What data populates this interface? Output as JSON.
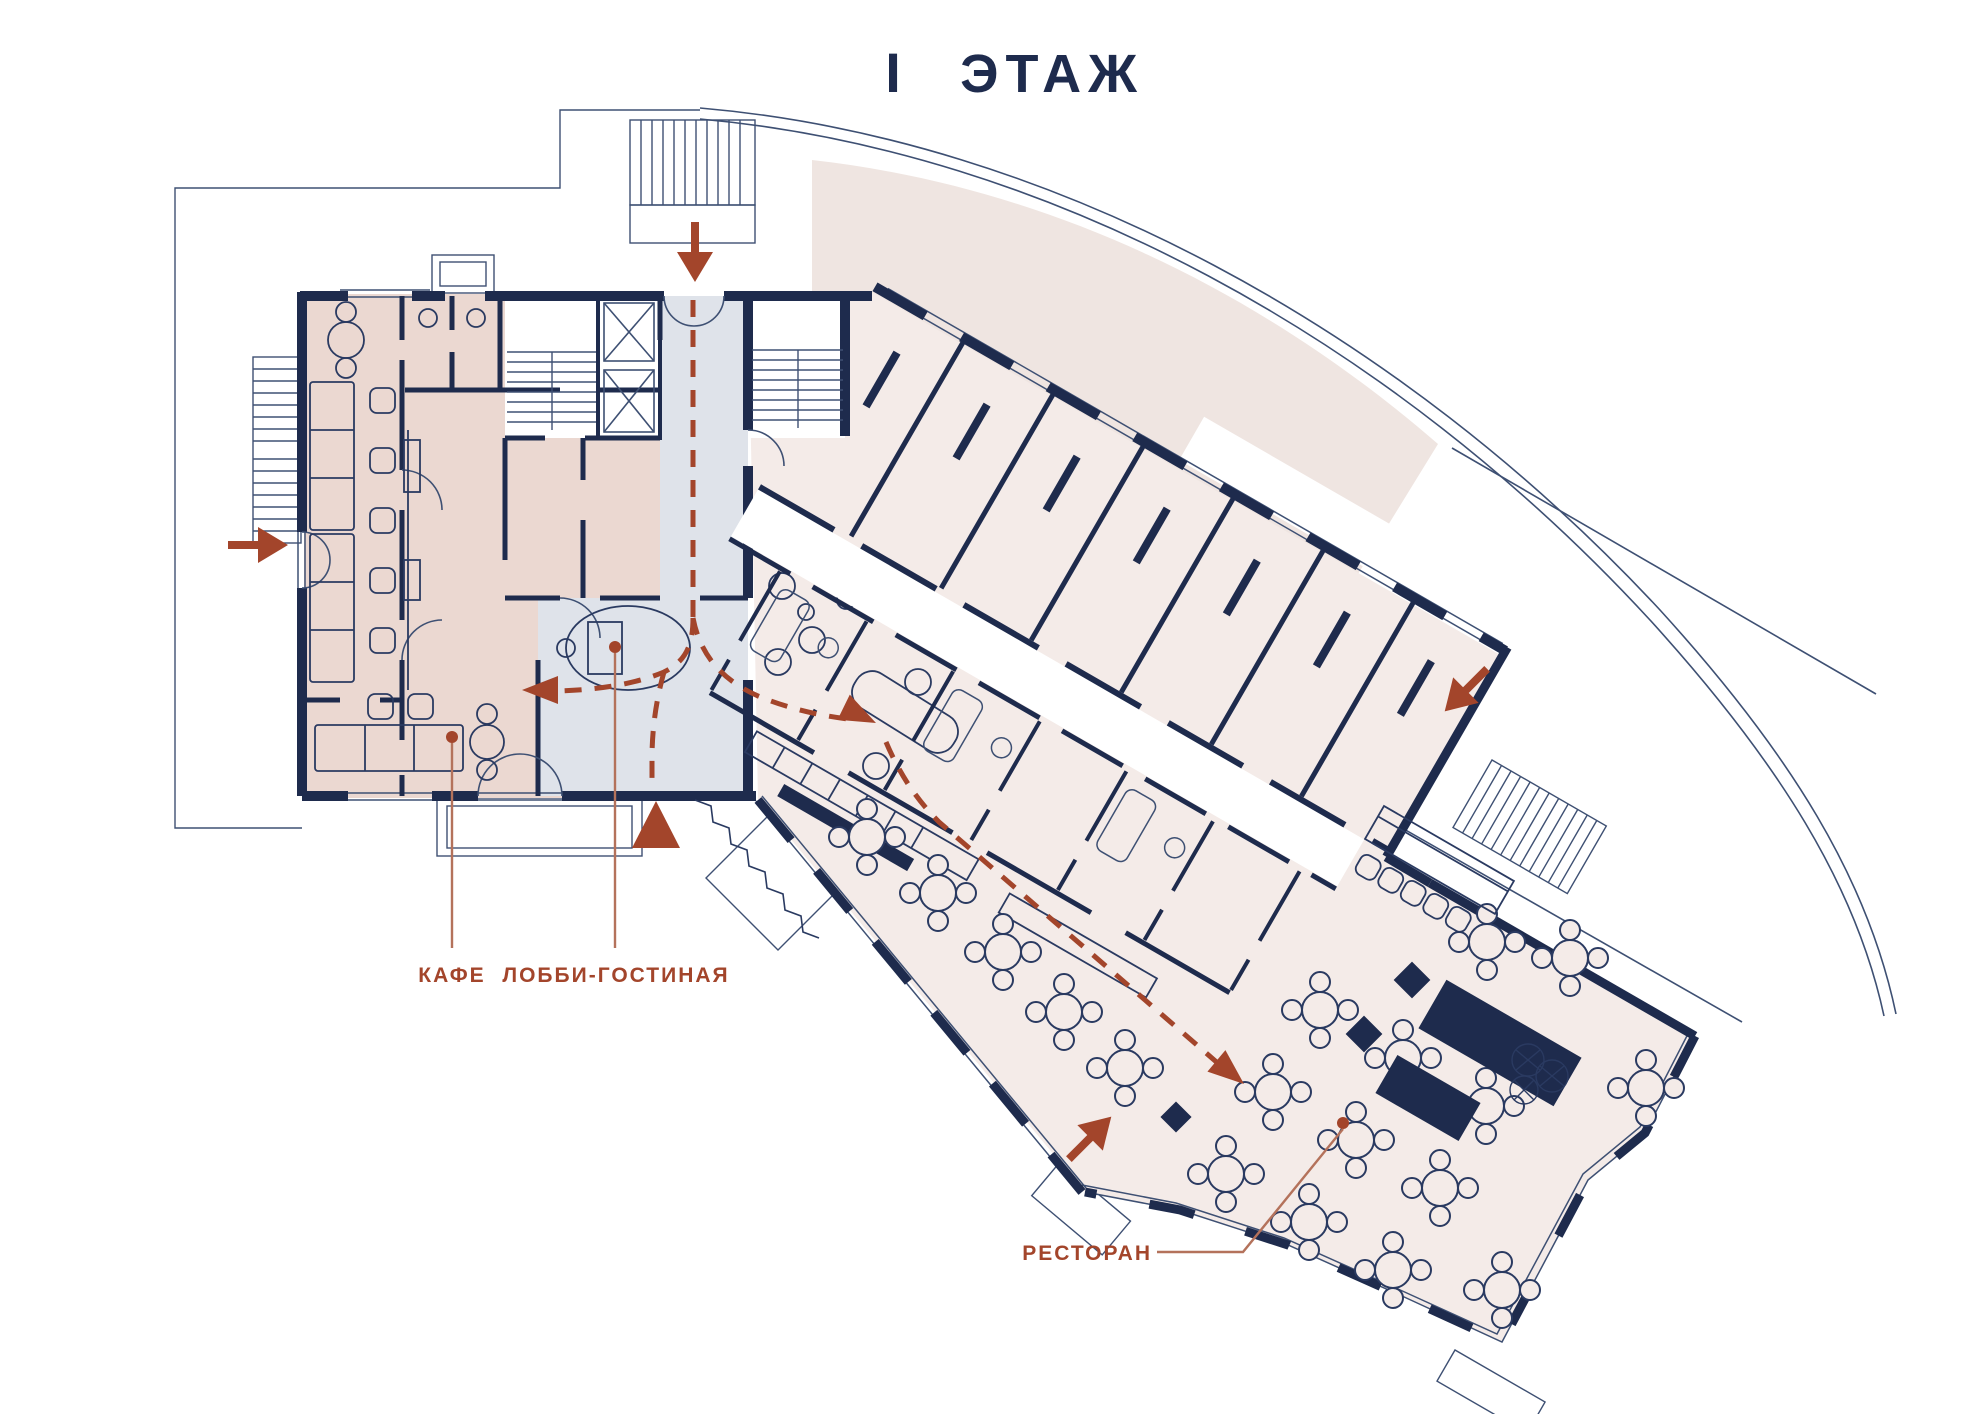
{
  "title": {
    "numeral": "I",
    "word": "ЭТАЖ"
  },
  "labels": {
    "cafe": "КАФЕ",
    "lobby": "ЛОББИ-ГОСТИНАЯ",
    "restaurant": "РЕСТОРАН"
  },
  "zones": [
    {
      "name": "cafe",
      "label": "КАФЕ",
      "fill": "#EBD8D1"
    },
    {
      "name": "lobby-lounge",
      "label": "ЛОББИ-ГОСТИНАЯ",
      "fill": "#DFE3EA"
    },
    {
      "name": "restaurant",
      "label": "РЕСТОРАН",
      "fill": "#F4EBE8"
    },
    {
      "name": "hotel-rooms-wing",
      "label": "",
      "fill": "#F4EBE8"
    },
    {
      "name": "terrace",
      "label": "",
      "fill": "#EFE5E1"
    }
  ],
  "entrances": [
    {
      "name": "main-entrance",
      "marker": "large-triangle-up"
    },
    {
      "name": "north-entrance",
      "marker": "arrow-down"
    },
    {
      "name": "west-entrance",
      "marker": "arrow-right"
    },
    {
      "name": "east-entrance",
      "marker": "arrow-down-left"
    },
    {
      "name": "south-entrance",
      "marker": "arrow-up-right"
    }
  ],
  "colors": {
    "wall_navy": "#1E2B4D",
    "thin_line": "#3E5073",
    "accent_red": "#A3452B",
    "leader_red": "#B4725B",
    "cafe_fill": "#EBD8D1",
    "lobby_fill": "#DFE3EA",
    "rooms_fill": "#F4EBE8",
    "terrace_fill": "#EFE5E1",
    "title_navy": "#1E2B4D"
  }
}
